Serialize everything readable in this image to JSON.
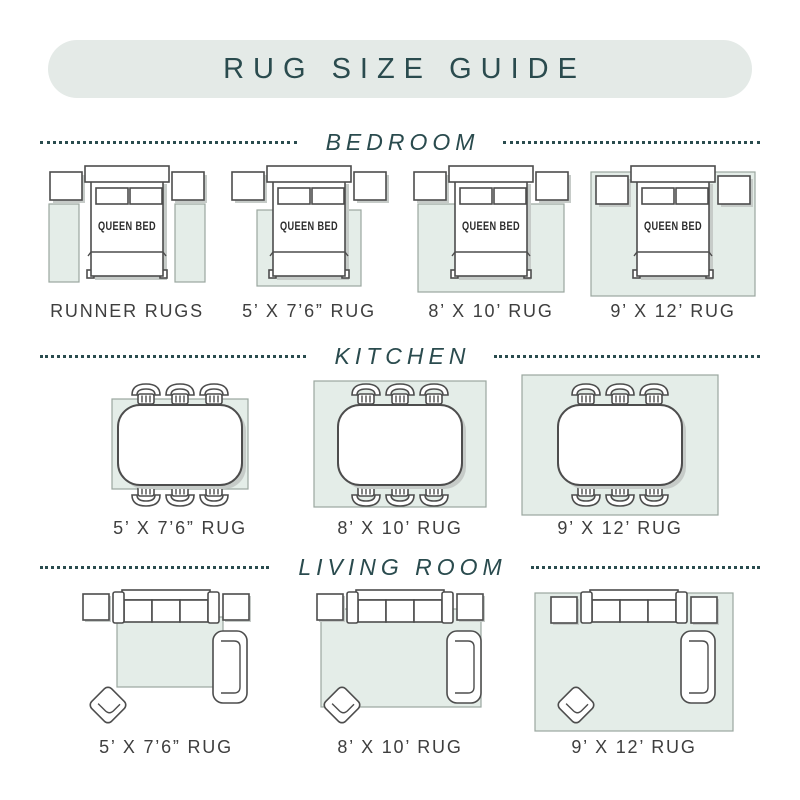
{
  "title": "RUG SIZE GUIDE",
  "bed": {
    "label": "QUEEN BED"
  },
  "sections": {
    "bedroom": {
      "title": "BEDROOM",
      "items": [
        {
          "label": "RUNNER RUGS"
        },
        {
          "label": "5’ X 7’6” RUG"
        },
        {
          "label": "8’ X 10’ RUG"
        },
        {
          "label": "9’ X 12’ RUG"
        }
      ]
    },
    "kitchen": {
      "title": "KITCHEN",
      "items": [
        {
          "label": "5’ X 7’6” RUG"
        },
        {
          "label": "8’ X 10’ RUG"
        },
        {
          "label": "9’ X 12’ RUG"
        }
      ]
    },
    "living_room": {
      "title": "LIVING ROOM",
      "items": [
        {
          "label": "5’ X 7’6” RUG"
        },
        {
          "label": "8’ X 10’ RUG"
        },
        {
          "label": "9’ X 12’ RUG"
        }
      ]
    }
  },
  "colors": {
    "accent": "#2a4b4e",
    "panel_bg": "#e4eae7",
    "rug_fill": "#e4ede8",
    "rug_border": "#9aa79f",
    "label_text": "#3e3e3e",
    "outline": "#4d4d4d",
    "shadow": "#c6cbc8"
  }
}
